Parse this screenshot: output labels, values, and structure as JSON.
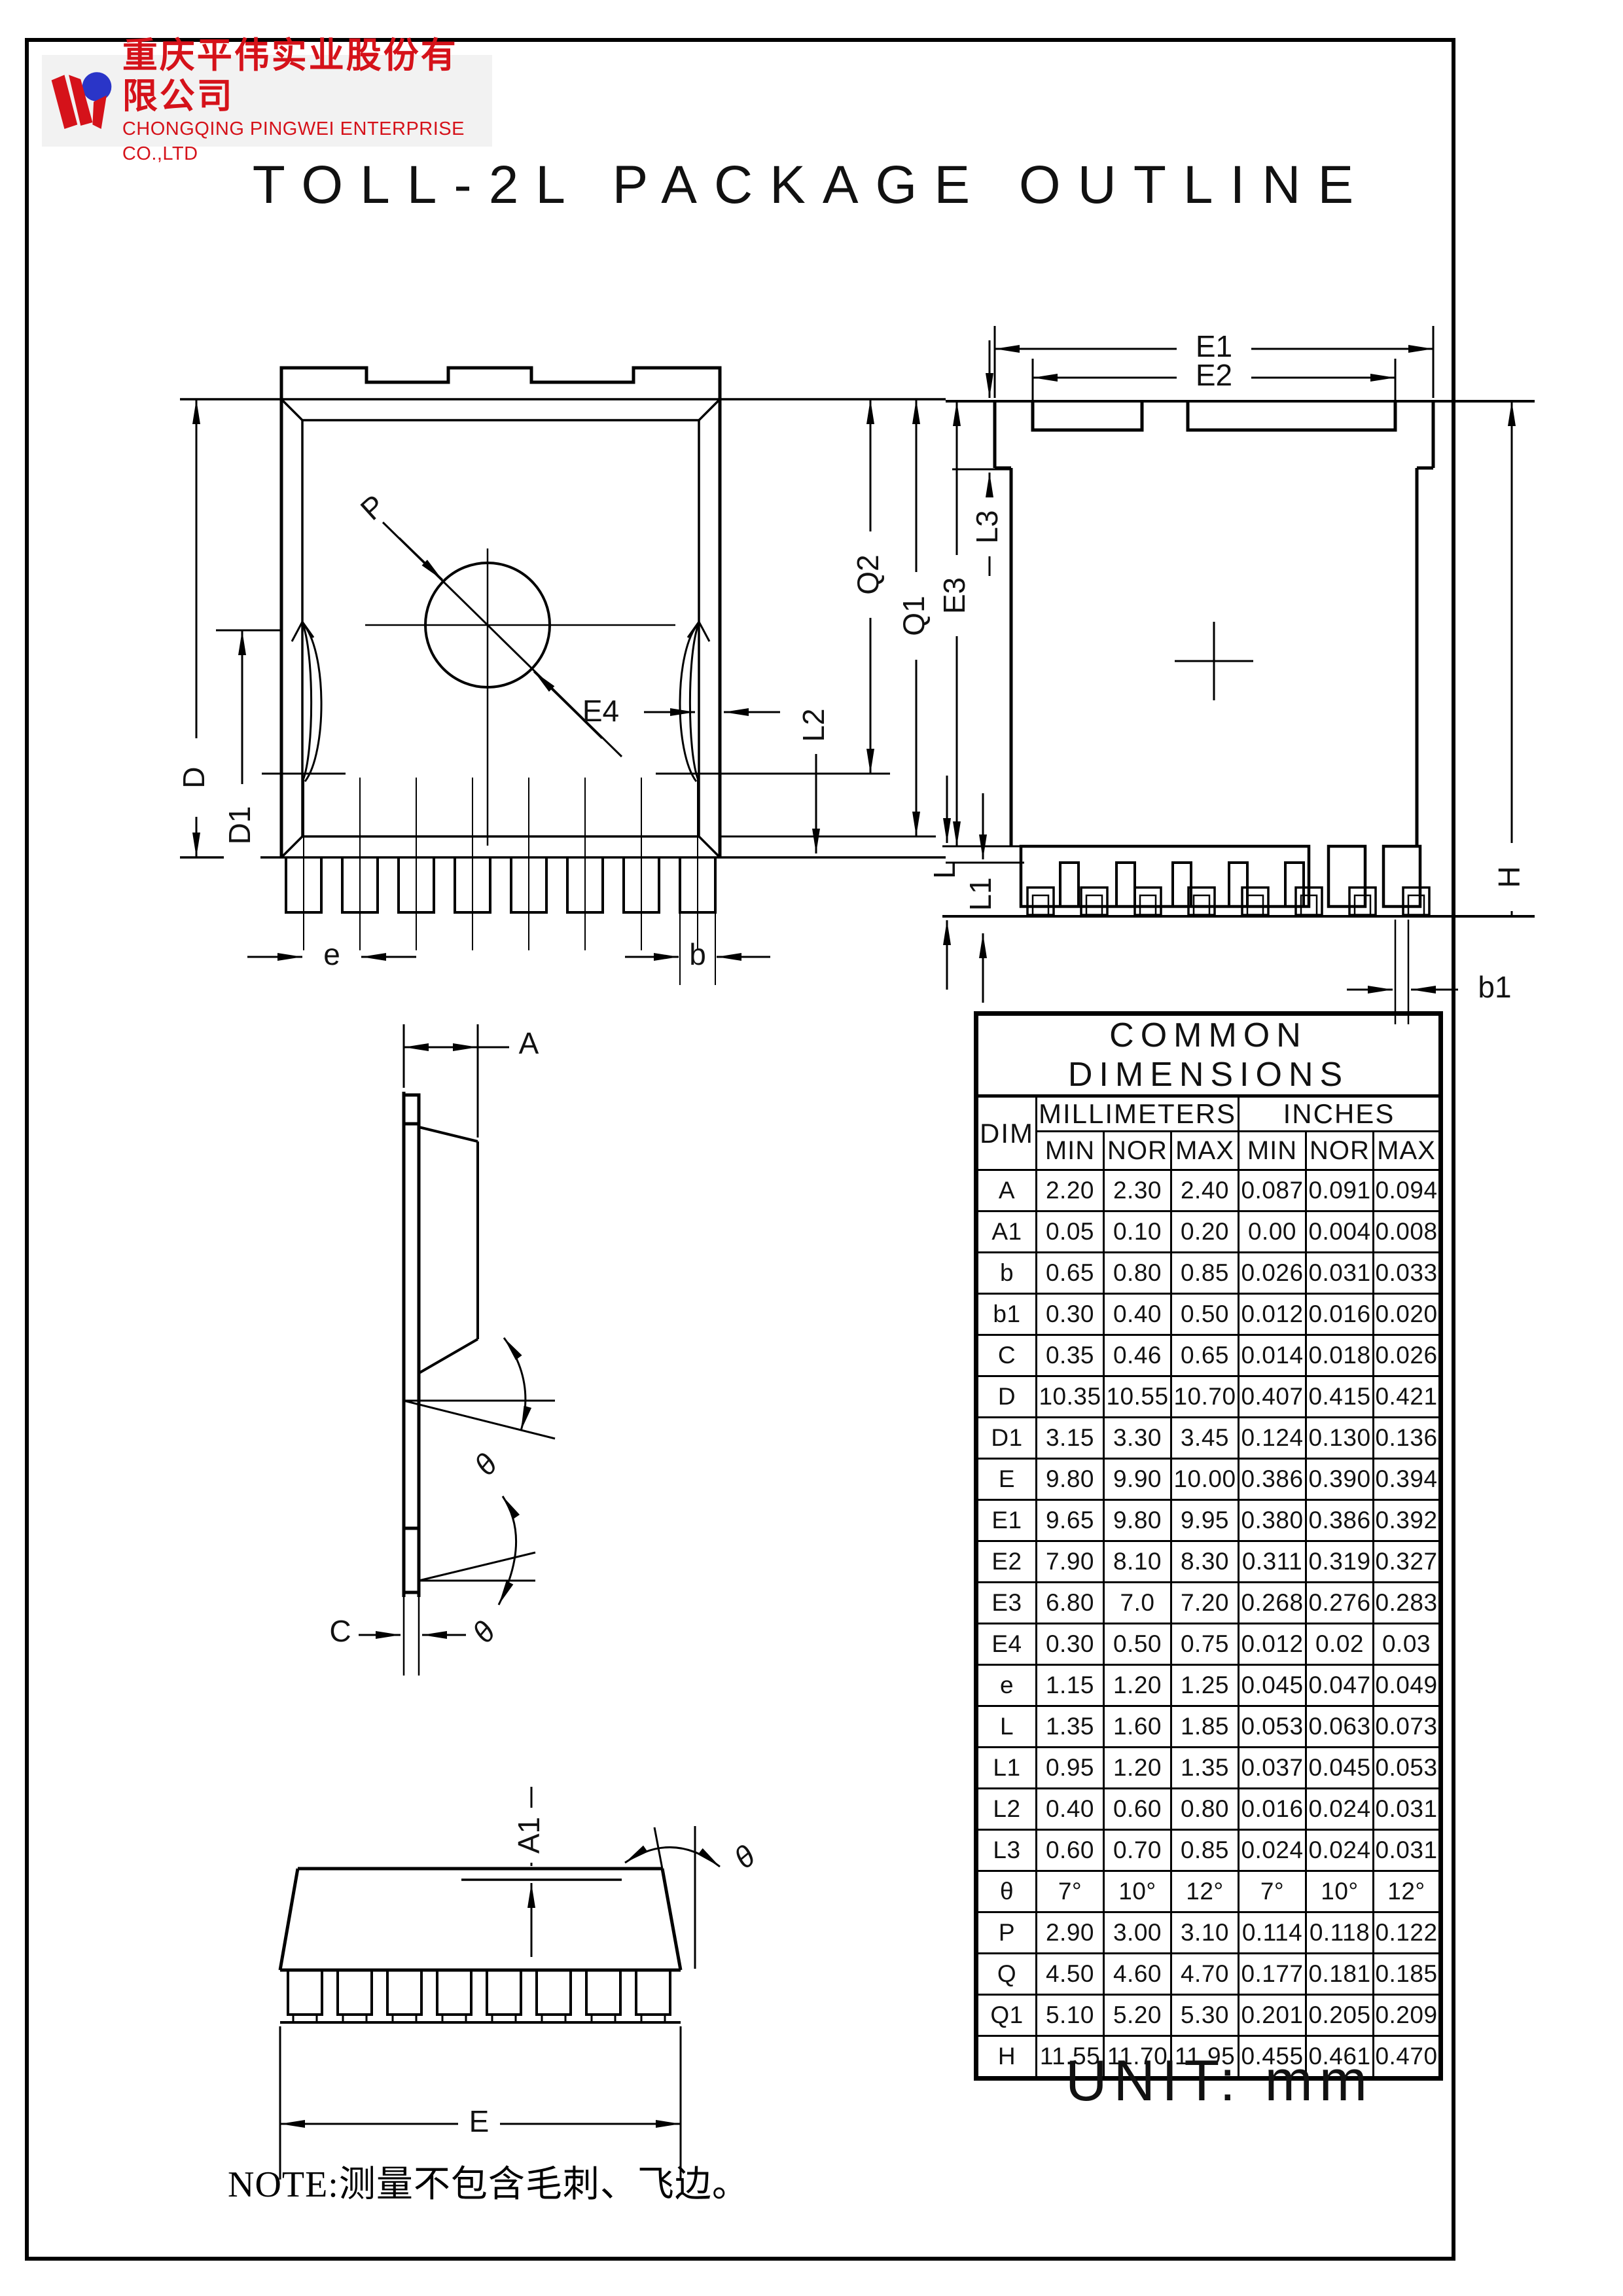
{
  "header": {
    "logo": {
      "company_cn": "重庆平伟实业股份有限公司",
      "company_en": "CHONGQING PINGWEI ENTERPRISE CO.,LTD",
      "brand_red": "#d5121a",
      "brand_blue": "#2a35c8"
    },
    "title": "TOLL-2L PACKAGE OUTLINE"
  },
  "drawings": {
    "top_view": {
      "labels": {
        "d": "D",
        "d1": "D1",
        "p": "P",
        "q2": "Q2",
        "q1": "Q1",
        "e4": "E4",
        "l2": "L2",
        "e": "e",
        "b": "b"
      }
    },
    "bottom_view": {
      "labels": {
        "e1": "E1",
        "e2": "E2",
        "e3": "E3",
        "l3": "L3",
        "l": "L",
        "l1": "L1",
        "h": "H",
        "b1": "b1"
      }
    },
    "side_view": {
      "labels": {
        "a": "A",
        "theta_upper": "θ",
        "theta_lower": "θ",
        "c": "C"
      }
    },
    "front_view": {
      "labels": {
        "a1": "A1",
        "theta": "θ",
        "e": "E"
      }
    }
  },
  "table": {
    "title": "COMMON DIMENSIONS",
    "dim_header": "DIM",
    "group_headers": [
      "MILLIMETERS",
      "INCHES"
    ],
    "sub_headers": [
      "MIN",
      "NOR",
      "MAX",
      "MIN",
      "NOR",
      "MAX"
    ],
    "rows": [
      {
        "dim": "A",
        "values": [
          "2.20",
          "2.30",
          "2.40",
          "0.087",
          "0.091",
          "0.094"
        ]
      },
      {
        "dim": "A1",
        "values": [
          "0.05",
          "0.10",
          "0.20",
          "0.00",
          "0.004",
          "0.008"
        ]
      },
      {
        "dim": "b",
        "values": [
          "0.65",
          "0.80",
          "0.85",
          "0.026",
          "0.031",
          "0.033"
        ]
      },
      {
        "dim": "b1",
        "values": [
          "0.30",
          "0.40",
          "0.50",
          "0.012",
          "0.016",
          "0.020"
        ]
      },
      {
        "dim": "C",
        "values": [
          "0.35",
          "0.46",
          "0.65",
          "0.014",
          "0.018",
          "0.026"
        ]
      },
      {
        "dim": "D",
        "values": [
          "10.35",
          "10.55",
          "10.70",
          "0.407",
          "0.415",
          "0.421"
        ]
      },
      {
        "dim": "D1",
        "values": [
          "3.15",
          "3.30",
          "3.45",
          "0.124",
          "0.130",
          "0.136"
        ]
      },
      {
        "dim": "E",
        "values": [
          "9.80",
          "9.90",
          "10.00",
          "0.386",
          "0.390",
          "0.394"
        ]
      },
      {
        "dim": "E1",
        "values": [
          "9.65",
          "9.80",
          "9.95",
          "0.380",
          "0.386",
          "0.392"
        ]
      },
      {
        "dim": "E2",
        "values": [
          "7.90",
          "8.10",
          "8.30",
          "0.311",
          "0.319",
          "0.327"
        ]
      },
      {
        "dim": "E3",
        "values": [
          "6.80",
          "7.0",
          "7.20",
          "0.268",
          "0.276",
          "0.283"
        ]
      },
      {
        "dim": "E4",
        "values": [
          "0.30",
          "0.50",
          "0.75",
          "0.012",
          "0.02",
          "0.03"
        ]
      },
      {
        "dim": "e",
        "values": [
          "1.15",
          "1.20",
          "1.25",
          "0.045",
          "0.047",
          "0.049"
        ]
      },
      {
        "dim": "L",
        "values": [
          "1.35",
          "1.60",
          "1.85",
          "0.053",
          "0.063",
          "0.073"
        ]
      },
      {
        "dim": "L1",
        "values": [
          "0.95",
          "1.20",
          "1.35",
          "0.037",
          "0.045",
          "0.053"
        ]
      },
      {
        "dim": "L2",
        "values": [
          "0.40",
          "0.60",
          "0.80",
          "0.016",
          "0.024",
          "0.031"
        ]
      },
      {
        "dim": "L3",
        "values": [
          "0.60",
          "0.70",
          "0.85",
          "0.024",
          "0.024",
          "0.031"
        ]
      },
      {
        "dim": "θ",
        "values": [
          "7°",
          "10°",
          "12°",
          "7°",
          "10°",
          "12°"
        ]
      },
      {
        "dim": "P",
        "values": [
          "2.90",
          "3.00",
          "3.10",
          "0.114",
          "0.118",
          "0.122"
        ]
      },
      {
        "dim": "Q",
        "values": [
          "4.50",
          "4.60",
          "4.70",
          "0.177",
          "0.181",
          "0.185"
        ]
      },
      {
        "dim": "Q1",
        "values": [
          "5.10",
          "5.20",
          "5.30",
          "0.201",
          "0.205",
          "0.209"
        ]
      },
      {
        "dim": "H",
        "values": [
          "11.55",
          "11.70",
          "11.95",
          "0.455",
          "0.461",
          "0.470"
        ]
      }
    ]
  },
  "footer": {
    "unit_label": "UNIT: mm",
    "note": "NOTE:测量不包含毛刺、飞边。"
  }
}
